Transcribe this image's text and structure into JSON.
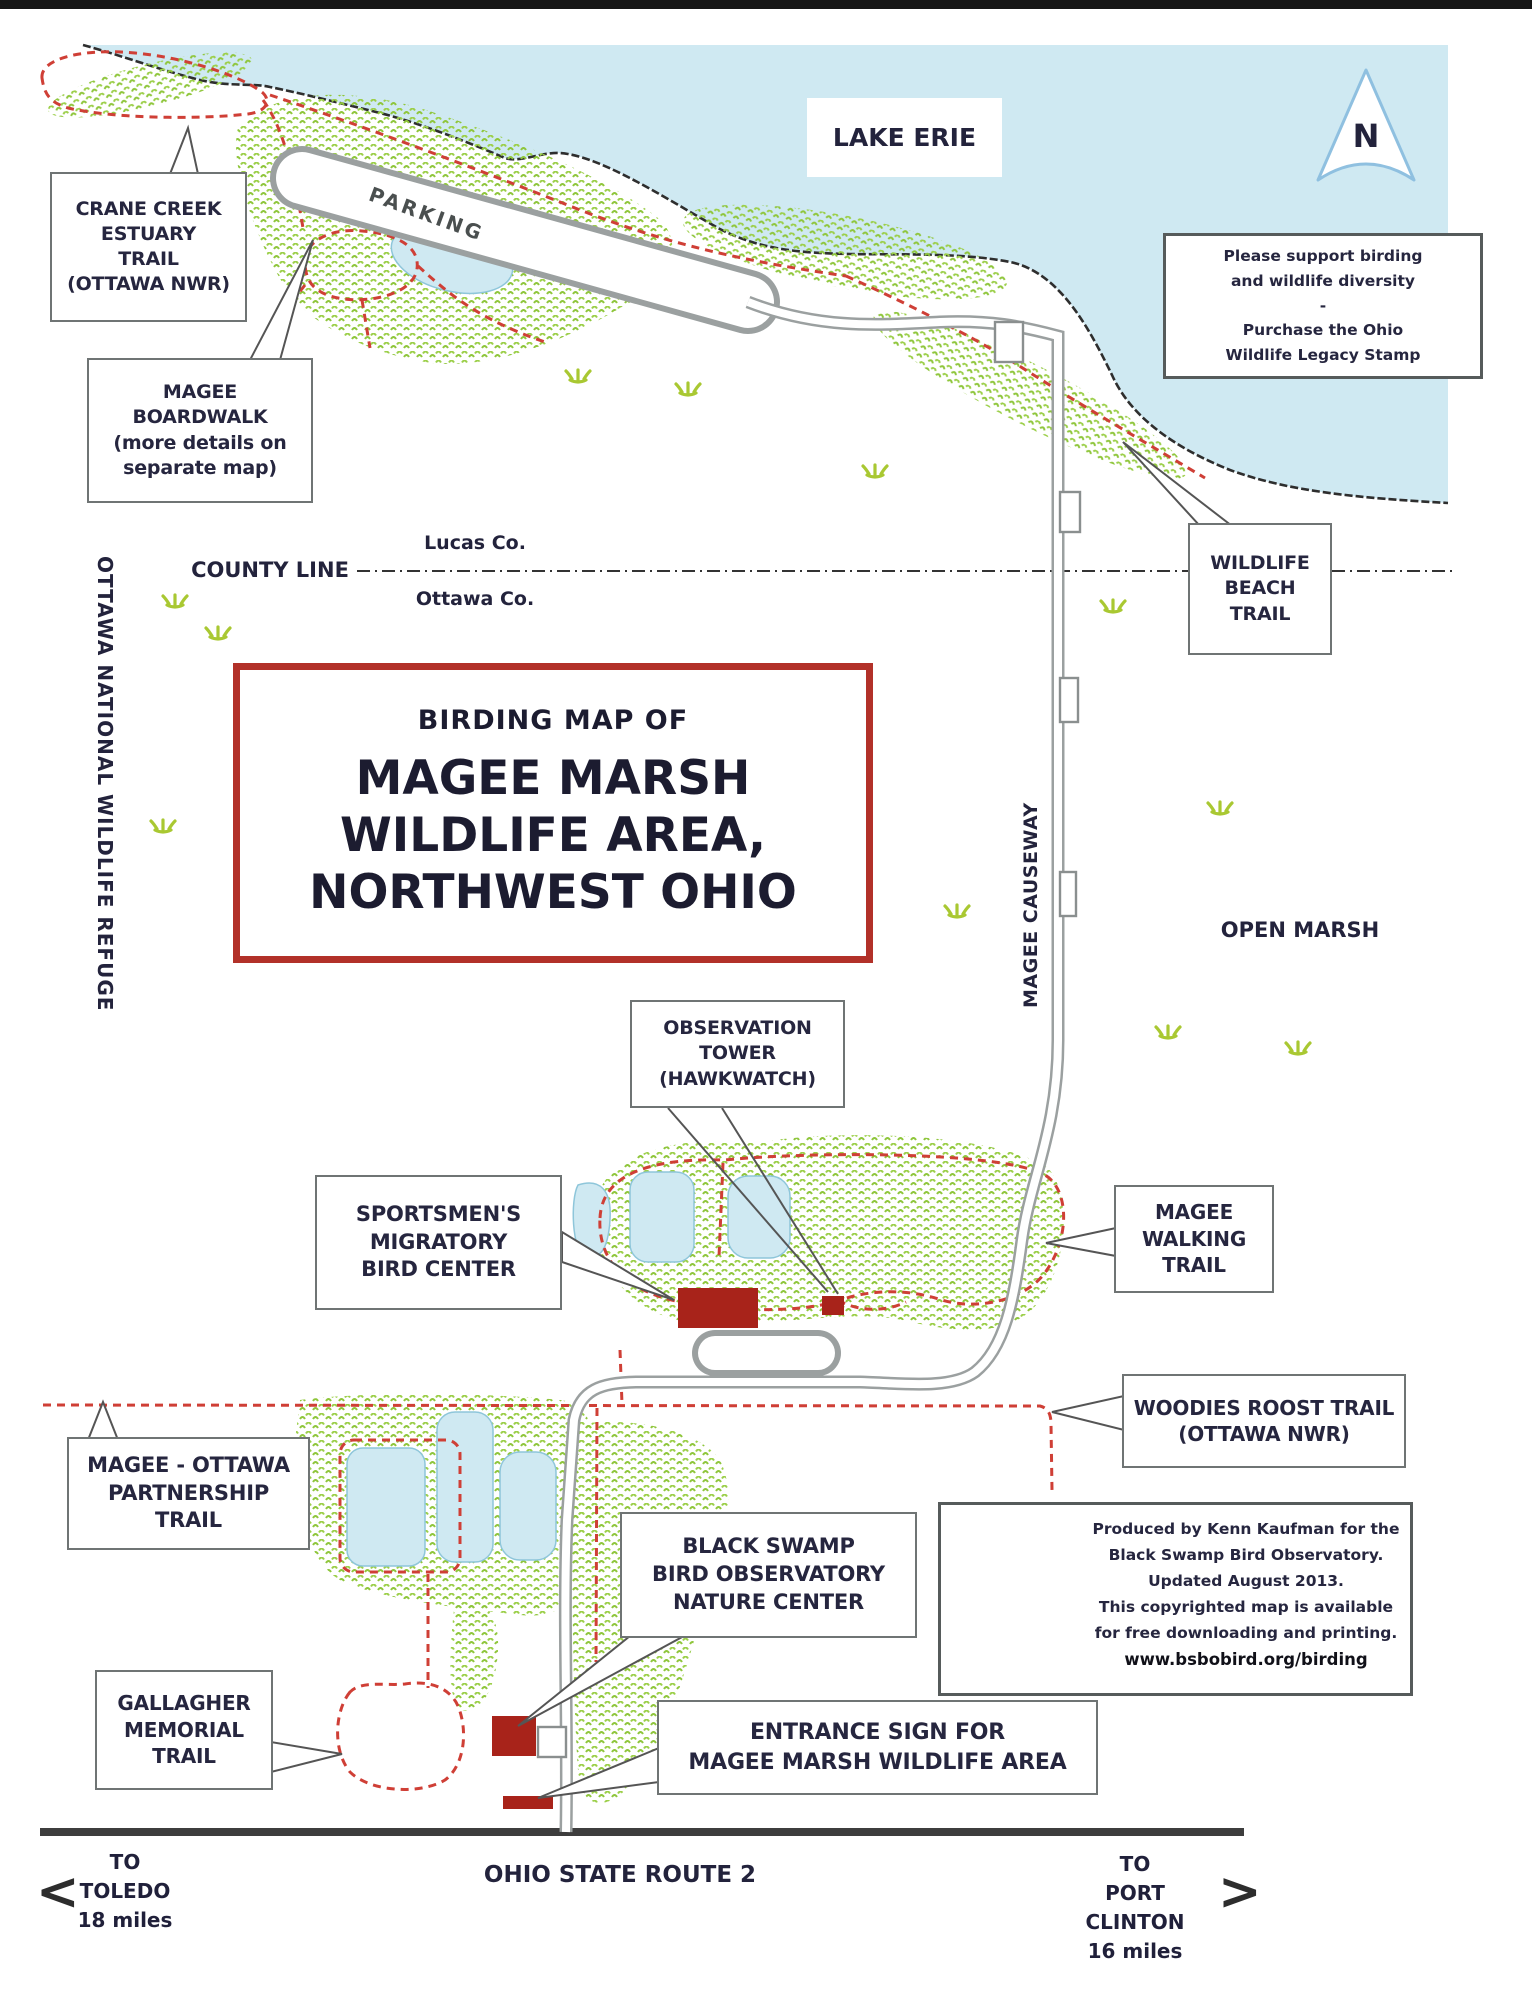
{
  "title": {
    "kicker": "BIRDING MAP OF",
    "line1": "MAGEE MARSH",
    "line2": "WILDLIFE AREA,",
    "line3": "NORTHWEST OHIO"
  },
  "labels": {
    "lake_erie": "LAKE ERIE",
    "open_marsh": "OPEN MARSH",
    "parking": "PARKING",
    "county_line": "COUNTY LINE",
    "lucas_co": "Lucas Co.",
    "ottawa_co": "Ottawa Co.",
    "refuge": "OTTAWA NATIONAL WILDLIFE REFUGE",
    "causeway": "MAGEE CAUSEWAY",
    "route2": "OHIO STATE ROUTE 2",
    "north": "N"
  },
  "callouts": {
    "crane": "CRANE CREEK\nESTUARY\nTRAIL\n(OTTAWA NWR)",
    "boardwalk": "MAGEE\nBOARDWALK\n(more details on\nseparate map)",
    "beach": "WILDLIFE\nBEACH\nTRAIL",
    "observation": "OBSERVATION\nTOWER\n(HAWKWATCH)",
    "sportsmens": "SPORTSMEN'S\nMIGRATORY\nBIRD CENTER",
    "walking": "MAGEE\nWALKING\nTRAIL",
    "woodies": "WOODIES ROOST TRAIL\n(OTTAWA NWR)",
    "partnership": "MAGEE - OTTAWA\nPARTNERSHIP\nTRAIL",
    "bsbo": "BLACK SWAMP\nBIRD OBSERVATORY\nNATURE CENTER",
    "gallagher": "GALLAGHER\nMEMORIAL\nTRAIL",
    "entrance": "ENTRANCE SIGN FOR\nMAGEE MARSH WILDLIFE AREA",
    "stamp": "Please support birding\nand wildlife diversity\n-\nPurchase the Ohio\nWildlife Legacy Stamp"
  },
  "credits": {
    "logo_top": "BLACK SWAMP",
    "logo_bottom": "BIRD OBSERVATORY",
    "lines": [
      "Produced by Kenn Kaufman for the",
      "Black Swamp Bird Observatory.",
      "Updated August 2013.",
      "This copyrighted map is available",
      "for free downloading and printing.",
      "www.bsbobird.org/birding"
    ]
  },
  "directions": {
    "toledo": "TO\nTOLEDO\n18 miles",
    "port_clinton": "TO\nPORT CLINTON\n16 miles",
    "west_arrow": "<",
    "east_arrow": ">"
  },
  "colors": {
    "lake": "#cfe9f2",
    "vegetation": "#8fc63c",
    "trail_red": "#cf3f36",
    "road_gray": "#9ba0a0",
    "building_red": "#a8231a",
    "title_border": "#b23129"
  }
}
